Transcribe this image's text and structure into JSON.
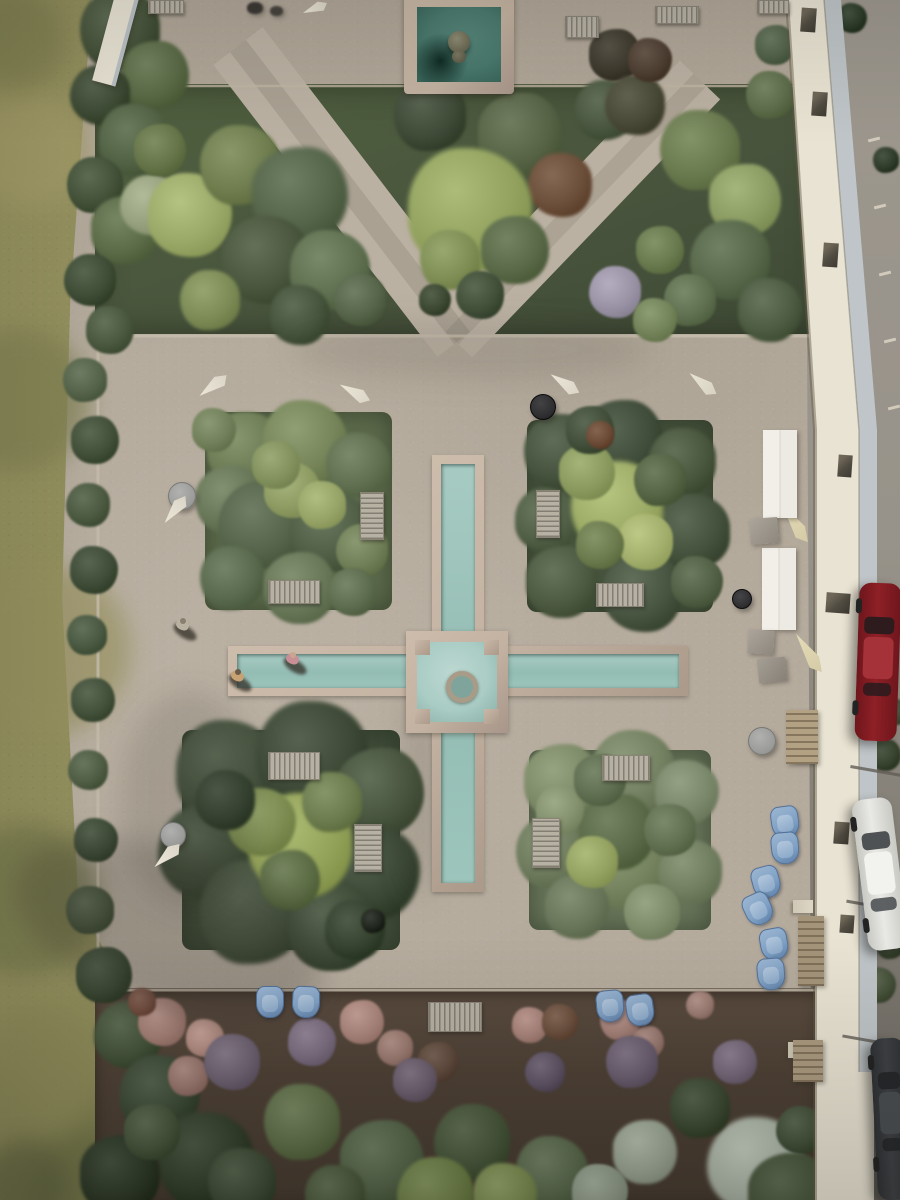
{
  "scene": {
    "title": "Aerial drone view of a formal walled garden with a cross-shaped turquoise rill, four square planting quadrants, gravel terraces, a square fountain pool, lawn to the left and a parking lane with cars to the right"
  },
  "palette": {
    "gravel": "#b5ab9d",
    "gravelPath": "#bbb1a3",
    "grass": "#8e8c5d",
    "bedTL": "#5d6b4c",
    "bedTR": "#46533d",
    "bedBL": "#404d39",
    "bedBR": "#68755a",
    "stone": "#c3b2a1",
    "stoneEdge": "#c6bcab",
    "waterRill": "#9dc5bc",
    "waterBasin": "#a9ccc4",
    "waterPool": "#4a7a6e",
    "wallCream": "#e9e3d3",
    "wallCoping": "#bfc5c8",
    "pave": "#98938a"
  },
  "grass_patches": [
    [
      30,
      150,
      60,
      "#a29a68"
    ],
    [
      20,
      400,
      70,
      "#7e7f52"
    ],
    [
      45,
      650,
      85,
      "#97915f"
    ],
    [
      25,
      900,
      75,
      "#6f7348"
    ],
    [
      65,
      1080,
      85,
      "#8c8a58"
    ],
    [
      150,
      1150,
      75,
      "#7c7d4e"
    ],
    [
      90,
      1190,
      60,
      "#6b7045"
    ],
    [
      15,
      40,
      50,
      "#7f7f50"
    ],
    [
      25,
      1185,
      45,
      "#5f6440"
    ]
  ],
  "foliage": [
    [
      120,
      30,
      40,
      "#45523a"
    ],
    [
      155,
      75,
      34,
      "#5a6a46"
    ],
    [
      100,
      95,
      30,
      "#3d4a34"
    ],
    [
      135,
      140,
      36,
      "#526244"
    ],
    [
      95,
      185,
      28,
      "#44523a"
    ],
    [
      125,
      230,
      34,
      "#5c6c49"
    ],
    [
      90,
      280,
      26,
      "#3f4d37"
    ],
    [
      110,
      330,
      24,
      "#4a5840"
    ],
    [
      85,
      380,
      22,
      "#55644a"
    ],
    [
      95,
      440,
      24,
      "#42503a"
    ],
    [
      88,
      505,
      22,
      "#4c5a42"
    ],
    [
      94,
      570,
      24,
      "#3f4d38"
    ],
    [
      87,
      635,
      20,
      "#4a5942"
    ],
    [
      93,
      700,
      22,
      "#43513b"
    ],
    [
      88,
      770,
      20,
      "#505e45"
    ],
    [
      96,
      840,
      22,
      "#3e4c37"
    ],
    [
      90,
      910,
      24,
      "#47553e"
    ],
    [
      104,
      975,
      28,
      "#3a4833"
    ],
    [
      128,
      1035,
      34,
      "#44523a"
    ],
    [
      160,
      1095,
      40,
      "#3b4935"
    ],
    [
      205,
      1160,
      48,
      "#323f2c"
    ],
    [
      120,
      1175,
      40,
      "#2c3827"
    ],
    [
      150,
      205,
      30,
      "#97a17f"
    ],
    [
      190,
      215,
      42,
      "#9aa968"
    ],
    [
      240,
      165,
      40,
      "#6f7d4f"
    ],
    [
      300,
      195,
      48,
      "#55654a"
    ],
    [
      265,
      260,
      44,
      "#4a573e"
    ],
    [
      330,
      270,
      40,
      "#5f7050"
    ],
    [
      210,
      300,
      30,
      "#7d8b57"
    ],
    [
      160,
      150,
      26,
      "#667549"
    ],
    [
      360,
      300,
      26,
      "#57664a"
    ],
    [
      300,
      315,
      30,
      "#46543d"
    ],
    [
      430,
      115,
      36,
      "#3f4a37"
    ],
    [
      520,
      135,
      42,
      "#576446"
    ],
    [
      560,
      185,
      32,
      "#6b4f3a"
    ],
    [
      470,
      210,
      62,
      "#93a35f"
    ],
    [
      450,
      260,
      30,
      "#7e8e55"
    ],
    [
      515,
      250,
      34,
      "#5a6a48"
    ],
    [
      480,
      295,
      24,
      "#42503a"
    ],
    [
      435,
      300,
      16,
      "#3c4832"
    ],
    [
      605,
      110,
      30,
      "#4a5740"
    ],
    [
      615,
      55,
      26,
      "#3e3a2e"
    ],
    [
      635,
      105,
      30,
      "#4a4a38"
    ],
    [
      650,
      60,
      22,
      "#4f3f33"
    ],
    [
      700,
      150,
      40,
      "#6a7a4f"
    ],
    [
      745,
      200,
      36,
      "#8b9c63"
    ],
    [
      730,
      260,
      40,
      "#57684a"
    ],
    [
      770,
      310,
      32,
      "#4d5c42"
    ],
    [
      690,
      300,
      26,
      "#5f7050"
    ],
    [
      660,
      250,
      24,
      "#697a4f"
    ],
    [
      615,
      292,
      26,
      "#9a93a5"
    ],
    [
      655,
      320,
      22,
      "#74845a"
    ],
    [
      770,
      95,
      24,
      "#5e6e4b"
    ],
    [
      775,
      45,
      20,
      "#52624a"
    ],
    [
      245,
      450,
      38,
      "#6d7c55"
    ],
    [
      305,
      442,
      42,
      "#77865a"
    ],
    [
      358,
      465,
      32,
      "#607050"
    ],
    [
      230,
      500,
      34,
      "#687758"
    ],
    [
      262,
      525,
      44,
      "#55644a"
    ],
    [
      332,
      532,
      40,
      "#4f5e45"
    ],
    [
      232,
      578,
      32,
      "#5a6a4e"
    ],
    [
      300,
      588,
      36,
      "#687758"
    ],
    [
      362,
      550,
      26,
      "#707f57"
    ],
    [
      292,
      490,
      28,
      "#8e9c64"
    ],
    [
      322,
      505,
      24,
      "#97a468"
    ],
    [
      276,
      465,
      24,
      "#82915e"
    ],
    [
      352,
      592,
      24,
      "#5e6d4f"
    ],
    [
      214,
      430,
      22,
      "#71805a"
    ],
    [
      562,
      452,
      38,
      "#46533e"
    ],
    [
      622,
      442,
      42,
      "#3f4c39"
    ],
    [
      682,
      462,
      34,
      "#4a573f"
    ],
    [
      547,
      520,
      32,
      "#515f46"
    ],
    [
      692,
      532,
      38,
      "#44513c"
    ],
    [
      562,
      582,
      36,
      "#4d5a42"
    ],
    [
      642,
      592,
      40,
      "#475440"
    ],
    [
      697,
      582,
      26,
      "#526046"
    ],
    [
      617,
      507,
      46,
      "#9cab66"
    ],
    [
      587,
      472,
      28,
      "#8b9a5f"
    ],
    [
      645,
      542,
      28,
      "#a3b06d"
    ],
    [
      600,
      545,
      24,
      "#6c7b4e"
    ],
    [
      660,
      480,
      26,
      "#556444"
    ],
    [
      590,
      430,
      24,
      "#424f3a"
    ],
    [
      600,
      435,
      14,
      "#6b4a36"
    ],
    [
      228,
      772,
      52,
      "#46523e"
    ],
    [
      312,
      757,
      56,
      "#3d4936"
    ],
    [
      380,
      792,
      44,
      "#48553f"
    ],
    [
      206,
      852,
      48,
      "#414e3a"
    ],
    [
      372,
      872,
      48,
      "#3a4734"
    ],
    [
      252,
      912,
      52,
      "#45523d"
    ],
    [
      332,
      927,
      44,
      "#3f4c38"
    ],
    [
      300,
      845,
      52,
      "#93a259"
    ],
    [
      262,
      822,
      34,
      "#7d8d52"
    ],
    [
      332,
      802,
      30,
      "#6c7c4e"
    ],
    [
      290,
      880,
      30,
      "#5c6c45"
    ],
    [
      225,
      800,
      30,
      "#374432"
    ],
    [
      355,
      930,
      30,
      "#35422f"
    ],
    [
      373,
      921,
      12,
      "#20251d"
    ],
    [
      562,
      782,
      38,
      "#7d8a68"
    ],
    [
      632,
      772,
      42,
      "#748162"
    ],
    [
      687,
      792,
      32,
      "#7a876a"
    ],
    [
      552,
      852,
      36,
      "#6d7a5c"
    ],
    [
      622,
      862,
      46,
      "#76835f"
    ],
    [
      690,
      872,
      32,
      "#717e60"
    ],
    [
      577,
      907,
      32,
      "#69765a"
    ],
    [
      652,
      912,
      28,
      "#7e8b6b"
    ],
    [
      617,
      832,
      38,
      "#5a6a48"
    ],
    [
      592,
      862,
      26,
      "#93a161"
    ],
    [
      560,
      810,
      24,
      "#84916e"
    ],
    [
      670,
      830,
      26,
      "#627052"
    ],
    [
      600,
      780,
      26,
      "#5f6d50"
    ],
    [
      162,
      1022,
      24,
      "#a37f76"
    ],
    [
      205,
      1038,
      19,
      "#b18c82"
    ],
    [
      188,
      1076,
      20,
      "#96756d"
    ],
    [
      362,
      1022,
      22,
      "#ab867d"
    ],
    [
      395,
      1048,
      18,
      "#9a7a71"
    ],
    [
      530,
      1025,
      18,
      "#a7837b"
    ],
    [
      620,
      1020,
      20,
      "#a5827a"
    ],
    [
      648,
      1042,
      16,
      "#97786f"
    ],
    [
      700,
      1005,
      14,
      "#9b7c73"
    ],
    [
      560,
      1022,
      18,
      "#6b4f3e"
    ],
    [
      142,
      1002,
      14,
      "#744f41"
    ],
    [
      438,
      1062,
      20,
      "#5f4a3d"
    ],
    [
      232,
      1062,
      28,
      "#6e6272"
    ],
    [
      312,
      1042,
      24,
      "#7b6d80"
    ],
    [
      632,
      1062,
      26,
      "#6a5e6f"
    ],
    [
      735,
      1062,
      22,
      "#75687a"
    ],
    [
      545,
      1072,
      20,
      "#5f5466"
    ],
    [
      415,
      1080,
      22,
      "#6b5e6e"
    ],
    [
      302,
      1122,
      38,
      "#5f6f4a"
    ],
    [
      382,
      1162,
      42,
      "#55654a"
    ],
    [
      472,
      1142,
      38,
      "#48573c"
    ],
    [
      552,
      1172,
      36,
      "#5a6a4e"
    ],
    [
      242,
      1182,
      34,
      "#3e4b36"
    ],
    [
      152,
      1132,
      28,
      "#46543c"
    ],
    [
      435,
      1195,
      38,
      "#6e8048"
    ],
    [
      505,
      1195,
      32,
      "#7b8c52"
    ],
    [
      335,
      1195,
      30,
      "#4c5a3e"
    ],
    [
      645,
      1152,
      32,
      "#9ba695"
    ],
    [
      755,
      1165,
      48,
      "#aab3a6"
    ],
    [
      600,
      1192,
      28,
      "#8e9a89"
    ],
    [
      700,
      1108,
      30,
      "#3c4a33"
    ],
    [
      790,
      1195,
      42,
      "#46543b"
    ],
    [
      800,
      1130,
      24,
      "#42503a"
    ],
    [
      852,
      18,
      15,
      "#2c3a28"
    ],
    [
      886,
      160,
      13,
      "#2f3b2a"
    ],
    [
      885,
      755,
      16,
      "#37422e"
    ],
    [
      895,
      712,
      13,
      "#414d37"
    ],
    [
      878,
      985,
      18,
      "#46513a"
    ],
    [
      890,
      945,
      14,
      "#3a4530"
    ]
  ],
  "shadows": [
    [
      170,
      930,
      160,
      80,
      20,
      "rgba(45,42,35,0.22)"
    ],
    [
      190,
      800,
      70,
      110,
      0,
      "rgba(45,42,35,0.14)"
    ],
    [
      420,
      790,
      20,
      110,
      0,
      "rgba(70,65,55,0.15)"
    ],
    [
      470,
      350,
      180,
      30,
      0,
      "rgba(60,58,48,0.12)"
    ]
  ],
  "benches": [
    [
      360,
      492,
      22,
      46
    ],
    [
      268,
      580,
      50,
      22
    ],
    [
      536,
      490,
      22,
      46
    ],
    [
      596,
      583,
      46,
      22
    ],
    [
      268,
      752,
      50,
      26
    ],
    [
      354,
      824,
      26,
      46
    ],
    [
      602,
      755,
      46,
      24
    ],
    [
      532,
      818,
      26,
      48
    ],
    [
      428,
      1002,
      52,
      28
    ],
    [
      148,
      0,
      34,
      12
    ],
    [
      565,
      16,
      32,
      20
    ],
    [
      655,
      6,
      42,
      16
    ],
    [
      757,
      0,
      30,
      12
    ]
  ],
  "tables": [
    [
      168,
      482,
      26,
      "#9c9c9a"
    ],
    [
      160,
      822,
      24,
      "#9a9a98"
    ],
    [
      748,
      727,
      26,
      "#9b9b99"
    ],
    [
      530,
      394,
      24,
      "#2d2d2f"
    ],
    [
      732,
      589,
      18,
      "#2f2f31"
    ]
  ],
  "umbrellas": [
    [
      196,
      378,
      -35,
      34,
      15,
      "#ece7d8"
    ],
    [
      338,
      385,
      30,
      34,
      15,
      "#ece7d8"
    ],
    [
      158,
      502,
      -50,
      34,
      15,
      "#ece7d8"
    ],
    [
      548,
      376,
      35,
      34,
      15,
      "#ece7d8"
    ],
    [
      686,
      376,
      40,
      34,
      15,
      "#e9e4d4"
    ],
    [
      150,
      848,
      -40,
      34,
      15,
      "#ece7d8"
    ],
    [
      772,
      515,
      58,
      46,
      16,
      "#e6dcb8"
    ],
    [
      786,
      645,
      58,
      46,
      16,
      "#e6dcb8"
    ],
    [
      302,
      2,
      -20,
      26,
      12,
      "#ece7d8"
    ]
  ],
  "chairs_blue": [
    [
      771,
      806,
      -8
    ],
    [
      771,
      832,
      -5
    ],
    [
      752,
      866,
      -15
    ],
    [
      744,
      893,
      -25
    ],
    [
      760,
      928,
      -10
    ],
    [
      757,
      958,
      -5
    ],
    [
      256,
      986,
      0
    ],
    [
      292,
      986,
      2
    ],
    [
      596,
      990,
      -5
    ],
    [
      626,
      994,
      -8
    ]
  ],
  "slabs": [
    [
      104,
      -10,
      20,
      95,
      15,
      "#e7e2d3",
      "wall"
    ],
    [
      763,
      430,
      34,
      88,
      0,
      "#edebe4",
      "table"
    ],
    [
      762,
      548,
      34,
      82,
      0,
      "#edebe4",
      "table"
    ],
    [
      750,
      518,
      28,
      26,
      -4,
      "#9b958b",
      "cube"
    ],
    [
      748,
      630,
      26,
      24,
      3,
      "#9b958b",
      "cube"
    ],
    [
      758,
      658,
      28,
      24,
      -6,
      "#948e84",
      "cube"
    ],
    [
      786,
      710,
      32,
      54,
      0,
      "#b3a184",
      "wood"
    ],
    [
      798,
      916,
      26,
      70,
      0,
      "#a4947a",
      "wood"
    ],
    [
      793,
      1040,
      30,
      42,
      0,
      "#ab9b80",
      "wood"
    ],
    [
      247,
      2,
      16,
      12,
      0,
      "#3b3734",
      "dark"
    ],
    [
      270,
      6,
      13,
      10,
      0,
      "#46423c",
      "dark"
    ]
  ],
  "kerbs": [
    [
      868,
      138
    ],
    [
      874,
      205
    ],
    [
      879,
      272
    ],
    [
      884,
      339
    ],
    [
      888,
      406
    ]
  ],
  "joints": [
    [
      850,
      770,
      58
    ],
    [
      846,
      905,
      62
    ],
    [
      842,
      1040,
      64
    ]
  ],
  "wall": {
    "windows": [
      [
        801,
        8,
        15,
        24
      ],
      [
        812,
        92,
        15,
        24
      ],
      [
        823,
        243,
        15,
        24
      ],
      [
        838,
        455,
        14,
        22
      ],
      [
        826,
        593,
        24,
        20
      ],
      [
        834,
        822,
        15,
        22
      ],
      [
        840,
        915,
        14,
        18
      ]
    ],
    "piers": [
      [
        797,
        748,
        18,
        14
      ],
      [
        793,
        900,
        20,
        13
      ],
      [
        788,
        1042,
        28,
        16
      ]
    ]
  },
  "cars": [
    {
      "x": 857,
      "y": 583,
      "w": 42,
      "h": 158,
      "rot": 2,
      "body": "#8e2026",
      "hi": "#a53238",
      "lo": "#6e161c",
      "win": "#2e1b1e",
      "name": "car-red"
    },
    {
      "x": 860,
      "y": 798,
      "w": 40,
      "h": 152,
      "rot": -7,
      "body": "#e9e9e5",
      "hi": "#f2f2ee",
      "lo": "#c9c9c4",
      "win": "#4e5254",
      "name": "car-white"
    },
    {
      "x": 874,
      "y": 1038,
      "w": 34,
      "h": 162,
      "rot": -3,
      "body": "#3e4145",
      "hi": "#4a4e52",
      "lo": "#2e3134",
      "win": "#25272a",
      "name": "car-dark"
    }
  ],
  "people": [
    {
      "x": 176,
      "y": 622,
      "shirt": "#b9b2a2",
      "head": "#8a7f6f",
      "name": "person-walking"
    },
    {
      "x": 286,
      "y": 656,
      "shirt": "#c98f96",
      "head": "#caa58f",
      "name": "person-sitting-rill"
    },
    {
      "x": 231,
      "y": 673,
      "shirt": "#c7a273",
      "head": "#6b5b4b",
      "name": "person-at-rill-end"
    }
  ]
}
